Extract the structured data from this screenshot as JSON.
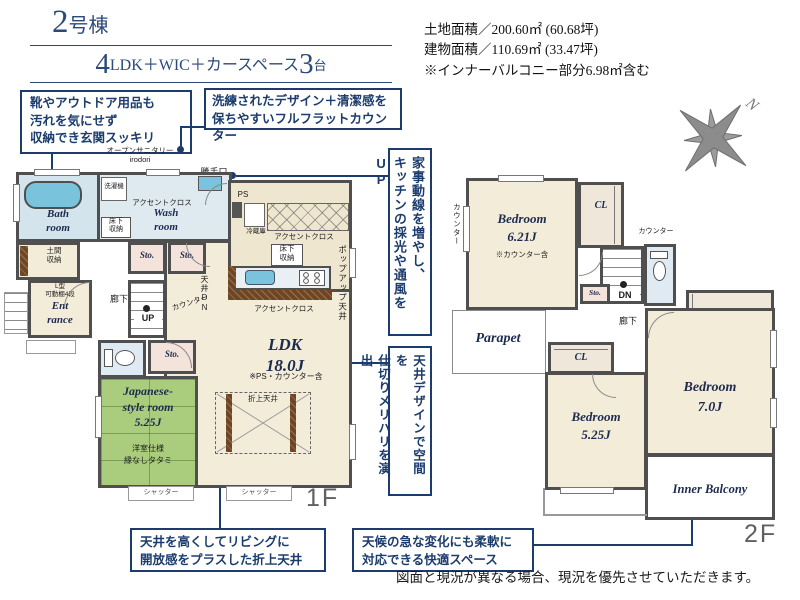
{
  "colors": {
    "accent_navy": "#1c3c6d",
    "title_navy": "#2b4a79",
    "wall_gray": "#4f4f4f",
    "room_beige": "#f3ecd9",
    "kitchen_beige": "#efe6cf",
    "bath_blue": "#d3e4ec",
    "fixture_blue": "#7ac3dc",
    "tatami_green": "#a9cd7c",
    "storage_pink": "#f3e3da",
    "counter_brown": "#6f4523"
  },
  "header": {
    "unit_num": "2",
    "unit_suffix": "号棟",
    "layout_num": "4",
    "layout_text": "LDK＋WIC＋カースペース",
    "cars_num": "3",
    "cars_unit": "台"
  },
  "info": {
    "land": "土地面積／200.60㎡ (60.68坪)",
    "building": "建物面積／110.69㎡ (33.47坪)",
    "note": "※インナーバルコニー部分6.98㎡含む"
  },
  "callouts": {
    "entrance_storage": "靴やアウトドア用品も\n汚れを気にせず\n収納でき玄関スッキリ",
    "flat_counter": "洗練されたデザイン＋清潔感を\n保ちやすいフルフラットカウンター",
    "housework_line": "家事動線を増やし、\nキッチンの採光や通風をUP",
    "ceiling_zoning": "天井デザインで空間を\n仕切りメリハリを演出",
    "coffered_ceiling": "天井を高くしてリビングに\n開放感をプラスした折上天井",
    "inner_balcony": "天候の急な変化にも柔軟に\n対応できる快適スペース"
  },
  "floor1": {
    "label": "1F",
    "open_sanitary": "オープンサニタリー\nirodori",
    "kitchen_door": "勝手口",
    "bath": "Bath\nroom",
    "washer": "洗濯機",
    "wash": "Wash\nroom",
    "accent_wash": "アクセントクロス",
    "underfloor": "床下\n収納",
    "doma": "土間\n収納",
    "sto": "Sto.",
    "shelf": "L型\n可動棚4段",
    "entrance": "Ent\nrance",
    "hall": "廊下",
    "up": "UP",
    "counter": "カウンター",
    "ceiling_dn": "天井DN",
    "ps": "PS",
    "fridge": "冷蔵庫",
    "accent_kitchen": "アクセントクロス",
    "accent_ldk": "アクセントクロス",
    "popup": "ポップアップ天井",
    "ldk": "LDK\n18.0J",
    "ldk_note": "※PS・カウンター含",
    "coffered": "折上天井",
    "jp_room": "Japanese-\nstyle room\n5.25J",
    "jp_note1": "洋室仕様",
    "jp_note2": "縁なしタタミ",
    "shutter": "シャッター"
  },
  "floor2": {
    "label": "2F",
    "counter_side": "カウンター",
    "counter_wc": "カウンター",
    "bedroom1": "Bedroom\n6.21J",
    "bedroom1_note": "※カウンター含",
    "cl": "CL",
    "dn": "DN",
    "sto": "Sto.",
    "hall": "廊下",
    "wic": "WIC",
    "parapet": "Parapet",
    "bedroom2": "Bedroom\n5.25J",
    "bedroom3": "Bedroom\n7.0J",
    "inner_balcony": "Inner Balcony"
  },
  "compass": {
    "north": "N"
  },
  "footer": {
    "disclaimer": "図面と現況が異なる場合、現況を優先させていただきます。"
  }
}
